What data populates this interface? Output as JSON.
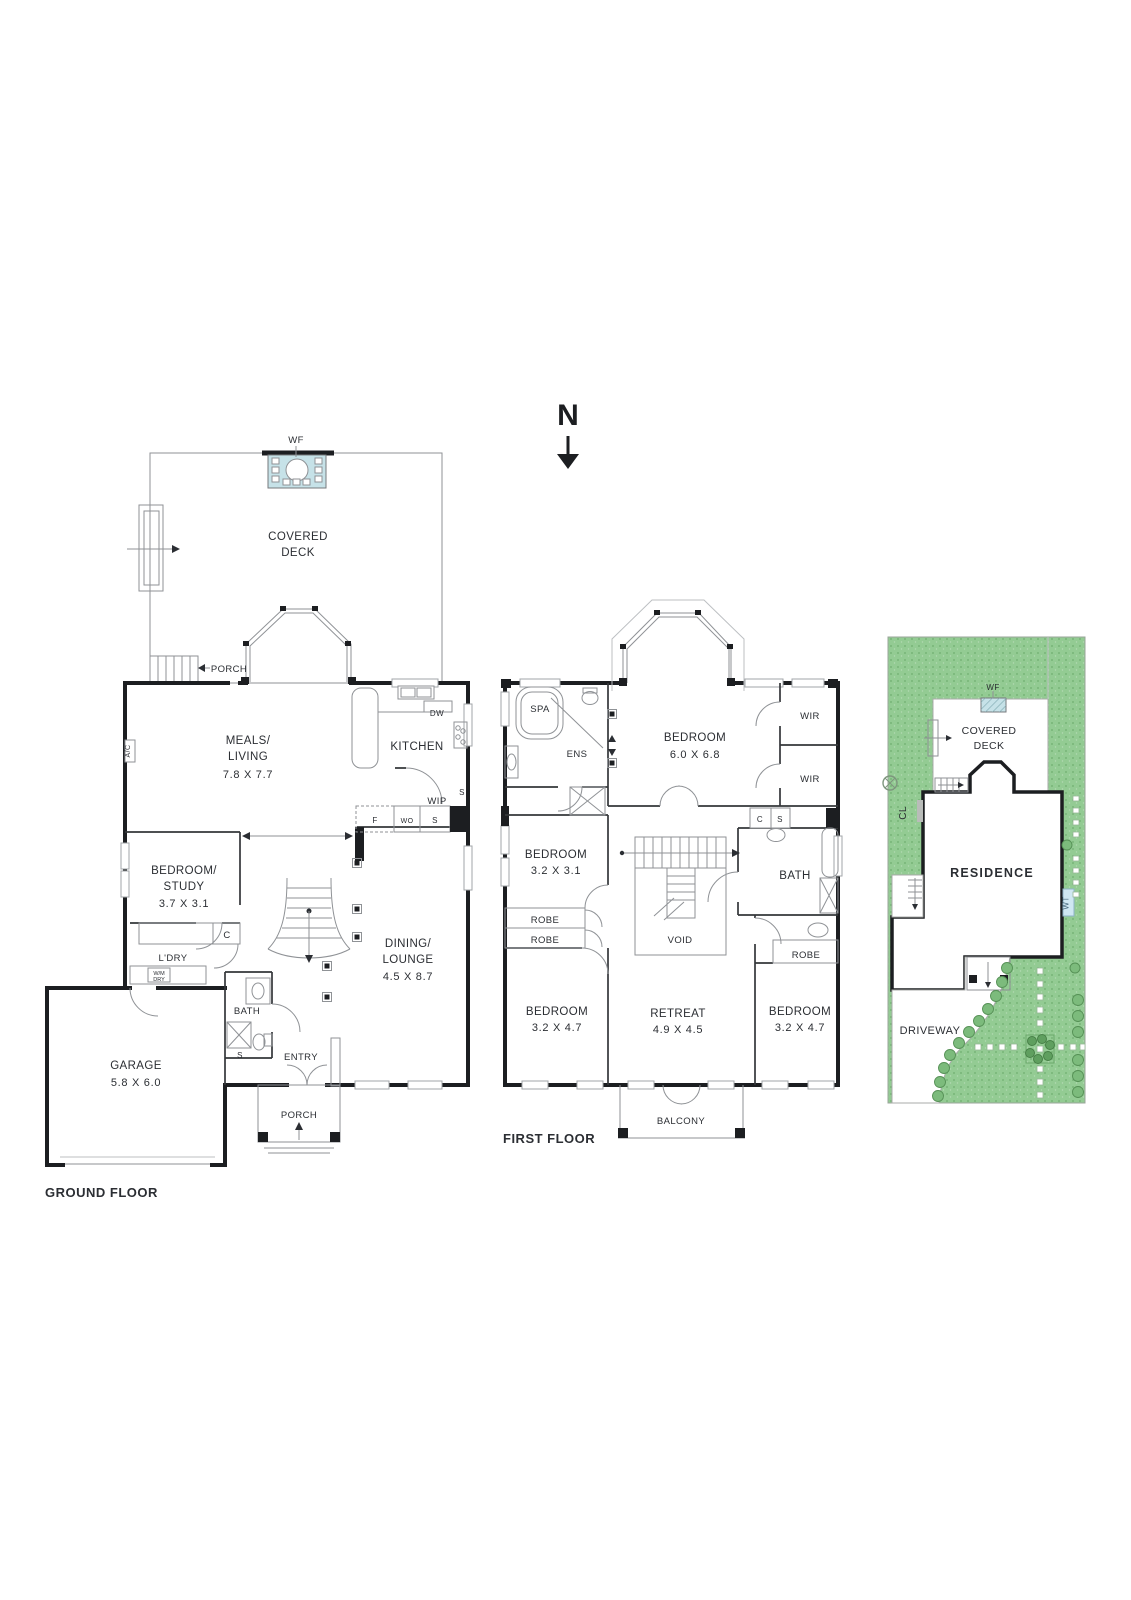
{
  "north": {
    "label": "N"
  },
  "colors": {
    "wall": "#1c1e21",
    "thin_line": "#8f9296",
    "lawn": "#93cb93",
    "lawn_dot": "#6fae6f",
    "water": "#c6e2e8",
    "wt_bg": "#cfe7f2",
    "text": "#2b2e33"
  },
  "ground": {
    "title": "GROUND FLOOR",
    "wf": "WF",
    "covered_l1": "COVERED",
    "covered_l2": "DECK",
    "porch_top": "PORCH",
    "meals_l1": "MEALS/",
    "meals_l2": "LIVING",
    "meals_dim": "7.8 X 7.7",
    "ac": "A/C",
    "kitchen": "KITCHEN",
    "dw": "DW",
    "wip": "WIP",
    "s_side": "S",
    "f": "F",
    "wo": "WO",
    "s_pantry": "S",
    "bed_l1": "BEDROOM/",
    "bed_l2": "STUDY",
    "bed_dim": "3.7 X 3.1",
    "c": "C",
    "ldry": "L'DRY",
    "wm": "W/M",
    "dry": "DRY",
    "bath": "BATH",
    "s_shower": "S",
    "entry": "ENTRY",
    "garage_l1": "GARAGE",
    "garage_dim": "5.8 X 6.0",
    "porch_bottom": "PORCH",
    "dining_l1": "DINING/",
    "dining_l2": "LOUNGE",
    "dining_dim": "4.5 X 8.7"
  },
  "first": {
    "title": "FIRST FLOOR",
    "spa": "SPA",
    "ens": "ENS",
    "bed1_l1": "BEDROOM",
    "bed1_dim": "6.0 X 6.8",
    "wir1": "WIR",
    "wir2": "WIR",
    "c": "C",
    "s": "S",
    "bed2_l1": "BEDROOM",
    "bed2_dim": "3.2 X 3.1",
    "robe1": "ROBE",
    "robe2": "ROBE",
    "void": "VOID",
    "bath": "BATH",
    "robe3": "ROBE",
    "bed3_l1": "BEDROOM",
    "bed3_dim": "3.2 X 4.7",
    "retreat_l1": "RETREAT",
    "retreat_dim": "4.9 X 4.5",
    "bed4_l1": "BEDROOM",
    "bed4_dim": "3.2 X 4.7",
    "balcony": "BALCONY"
  },
  "site": {
    "wf": "WF",
    "deck_l1": "COVERED",
    "deck_l2": "DECK",
    "cl": "CL",
    "residence": "RESIDENCE",
    "wt": "WT",
    "driveway": "DRIVEWAY"
  }
}
